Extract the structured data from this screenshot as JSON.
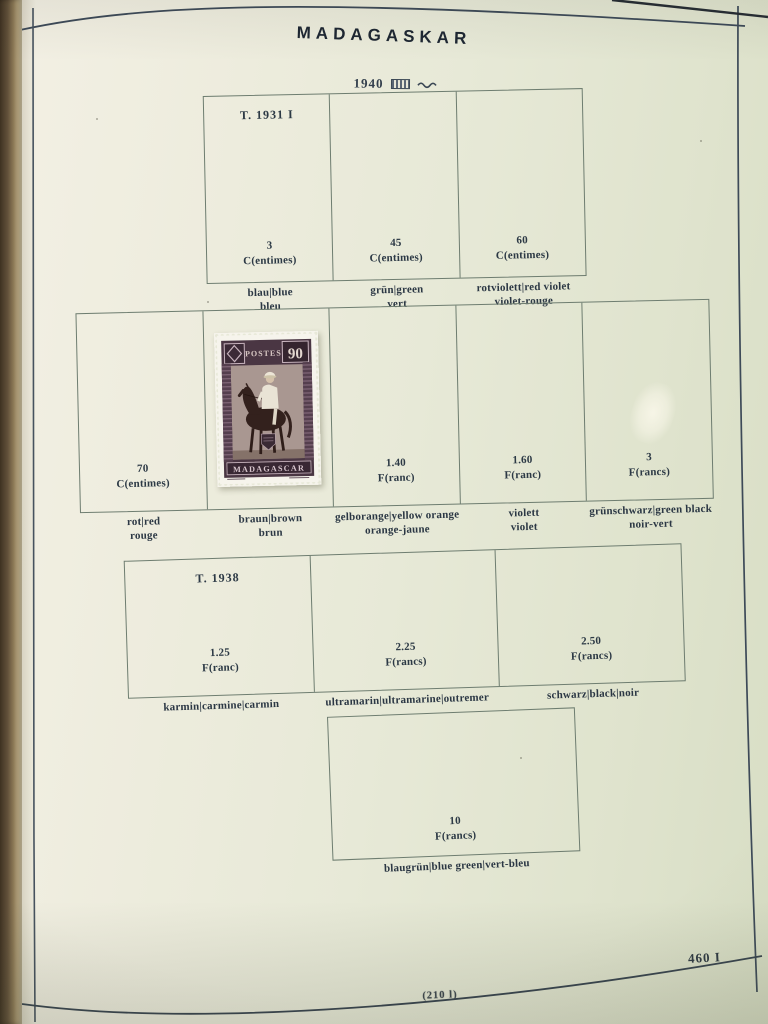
{
  "header": {
    "title": "MADAGASKAR",
    "year": "1940"
  },
  "footer": {
    "page_number": "460 I",
    "plate_note": "(210 l)"
  },
  "stamp": {
    "country": "MADAGASCAR",
    "denomination": "90",
    "top_inscription": "POSTES"
  },
  "sections": {
    "row1": {
      "type_note": "T. 1931 I",
      "cells": [
        {
          "value": "3",
          "unit": "C(entimes)",
          "caption1": "blau|blue",
          "caption2": "bleu"
        },
        {
          "value": "45",
          "unit": "C(entimes)",
          "caption1": "grün|green",
          "caption2": "vert"
        },
        {
          "value": "60",
          "unit": "C(entimes)",
          "caption1": "rotviolett|red violet",
          "caption2": "violet-rouge"
        }
      ]
    },
    "row2": {
      "cells": [
        {
          "value": "70",
          "unit": "C(entimes)",
          "caption1": "rot|red",
          "caption2": "rouge"
        },
        {
          "value": "",
          "unit": "",
          "caption1": "braun|brown",
          "caption2": "brun"
        },
        {
          "value": "1.40",
          "unit": "F(ranc)",
          "caption1": "gelborange|yellow orange",
          "caption2": "orange-jaune"
        },
        {
          "value": "1.60",
          "unit": "F(ranc)",
          "caption1": "violett",
          "caption2": "violet"
        },
        {
          "value": "3",
          "unit": "F(rancs)",
          "caption1": "grünschwarz|green black",
          "caption2": "noir-vert"
        }
      ]
    },
    "row3": {
      "type_note": "T. 1938",
      "cells": [
        {
          "value": "1.25",
          "unit": "F(ranc)",
          "caption1": "karmin|carmine|carmin",
          "caption2": ""
        },
        {
          "value": "2.25",
          "unit": "F(rancs)",
          "caption1": "ultramarin|ultramarine|outremer",
          "caption2": ""
        },
        {
          "value": "2.50",
          "unit": "F(rancs)",
          "caption1": "schwarz|black|noir",
          "caption2": ""
        }
      ]
    },
    "row4": {
      "cells": [
        {
          "value": "10",
          "unit": "F(rancs)",
          "caption1": "blaugrün|blue green|vert-bleu",
          "caption2": ""
        }
      ]
    }
  },
  "colors": {
    "page_paper": "#eaead9",
    "border_ink": "#3c4a59",
    "box_line": "#6e7d70",
    "text_ink": "#2c3945",
    "binding_leather": "#62513a",
    "stamp_frame": "#4a3643",
    "stamp_vignette": "#a99791",
    "stamp_paper": "#f6f4ec"
  }
}
